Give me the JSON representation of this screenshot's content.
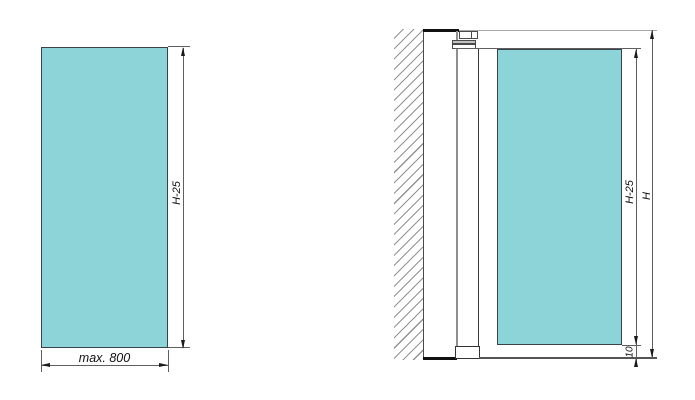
{
  "colors": {
    "glass-fill": "#8dd4d8",
    "line-dark": "#37424a",
    "line-dim": "#5f5f5f",
    "line-light": "#a8a8a8",
    "hatch": "#929292",
    "arrow": "#1a1a1a"
  },
  "front_view": {
    "height_label": "H-25",
    "width_label": "max. 800"
  },
  "side_view": {
    "glass_height_label": "H-25",
    "total_height_label": "H",
    "bottom_gap_label": "10"
  }
}
